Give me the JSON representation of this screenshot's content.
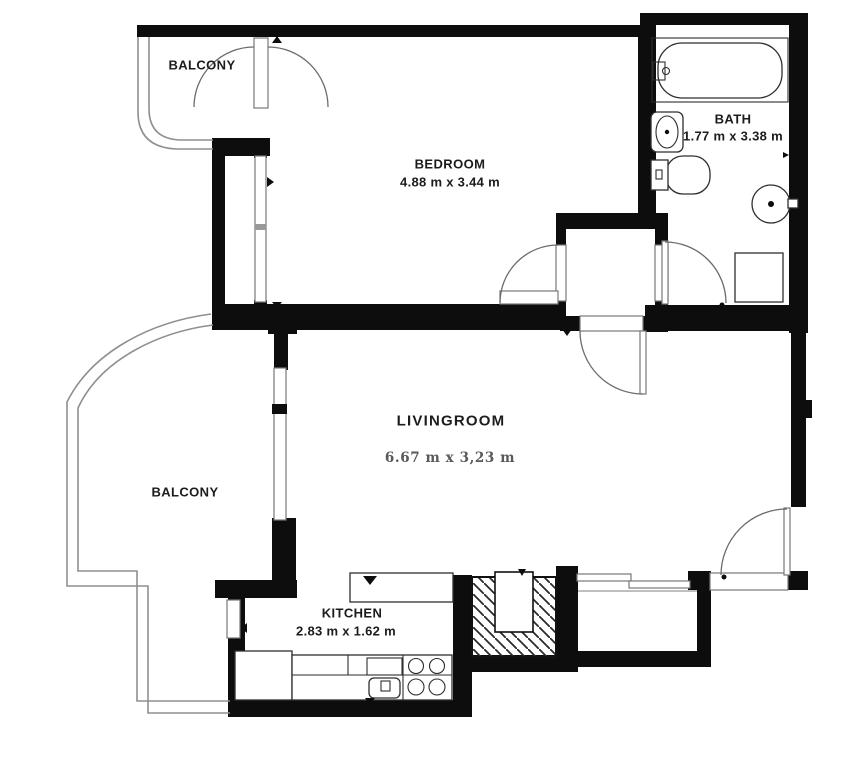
{
  "floorplan": {
    "rooms": {
      "balcony_top": {
        "label": "BALCONY"
      },
      "bedroom": {
        "label": "BEDROOM",
        "dimensions": "4.88 m x 3.44 m"
      },
      "bath": {
        "label": "BATH",
        "dimensions": "1.77 m x 3.38 m"
      },
      "livingroom": {
        "label": "LIVINGROOM",
        "dimensions": "6.67 m x 3,23 m"
      },
      "balcony_left": {
        "label": "BALCONY"
      },
      "kitchen": {
        "label": "KITCHEN",
        "dimensions": "2.83 m x 1.62 m"
      }
    },
    "colors": {
      "wall": "#0d0d0d",
      "railing": "#8f8f8f",
      "text": "#1c1c1c",
      "dim_text": "#595959",
      "background": "#ffffff"
    }
  }
}
